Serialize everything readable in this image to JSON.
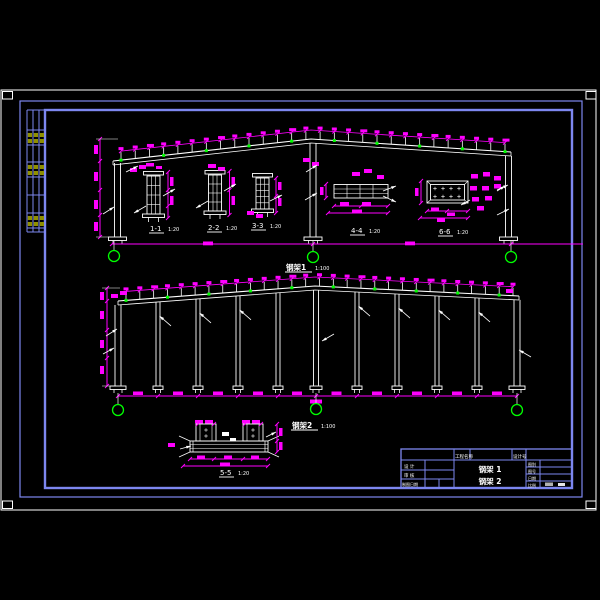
{
  "palette": {
    "background": "#000000",
    "line": "#ffffff",
    "dimension": "#ff00ff",
    "axis_bubble": "#00ff00",
    "frame_blue": "#7d87f0",
    "table_text": "#8f8f00"
  },
  "drawing1": {
    "title": "钢架1",
    "scale": "1:100",
    "sections": [
      {
        "label": "1-1",
        "scale": "1:20"
      },
      {
        "label": "2-2",
        "scale": "1:20"
      },
      {
        "label": "3-3",
        "scale": "1:20"
      },
      {
        "label": "4-4",
        "scale": "1:20"
      },
      {
        "label": "6-6",
        "scale": "1:20"
      }
    ]
  },
  "drawing2": {
    "title": "钢架2",
    "scale": "1:100"
  },
  "section5": {
    "label": "5-5",
    "scale": "1:20"
  },
  "title_block": {
    "project_label": "工程名称",
    "serial_label": "设计号",
    "designer_label": "设 计",
    "checker_label": "审 核",
    "draw_date_label": "制图日期",
    "category_label": "图别",
    "number_label": "图号",
    "date_label": "日期",
    "scale_label": "比例",
    "content_line1": "钢架 1",
    "content_line2": "钢架 2"
  }
}
